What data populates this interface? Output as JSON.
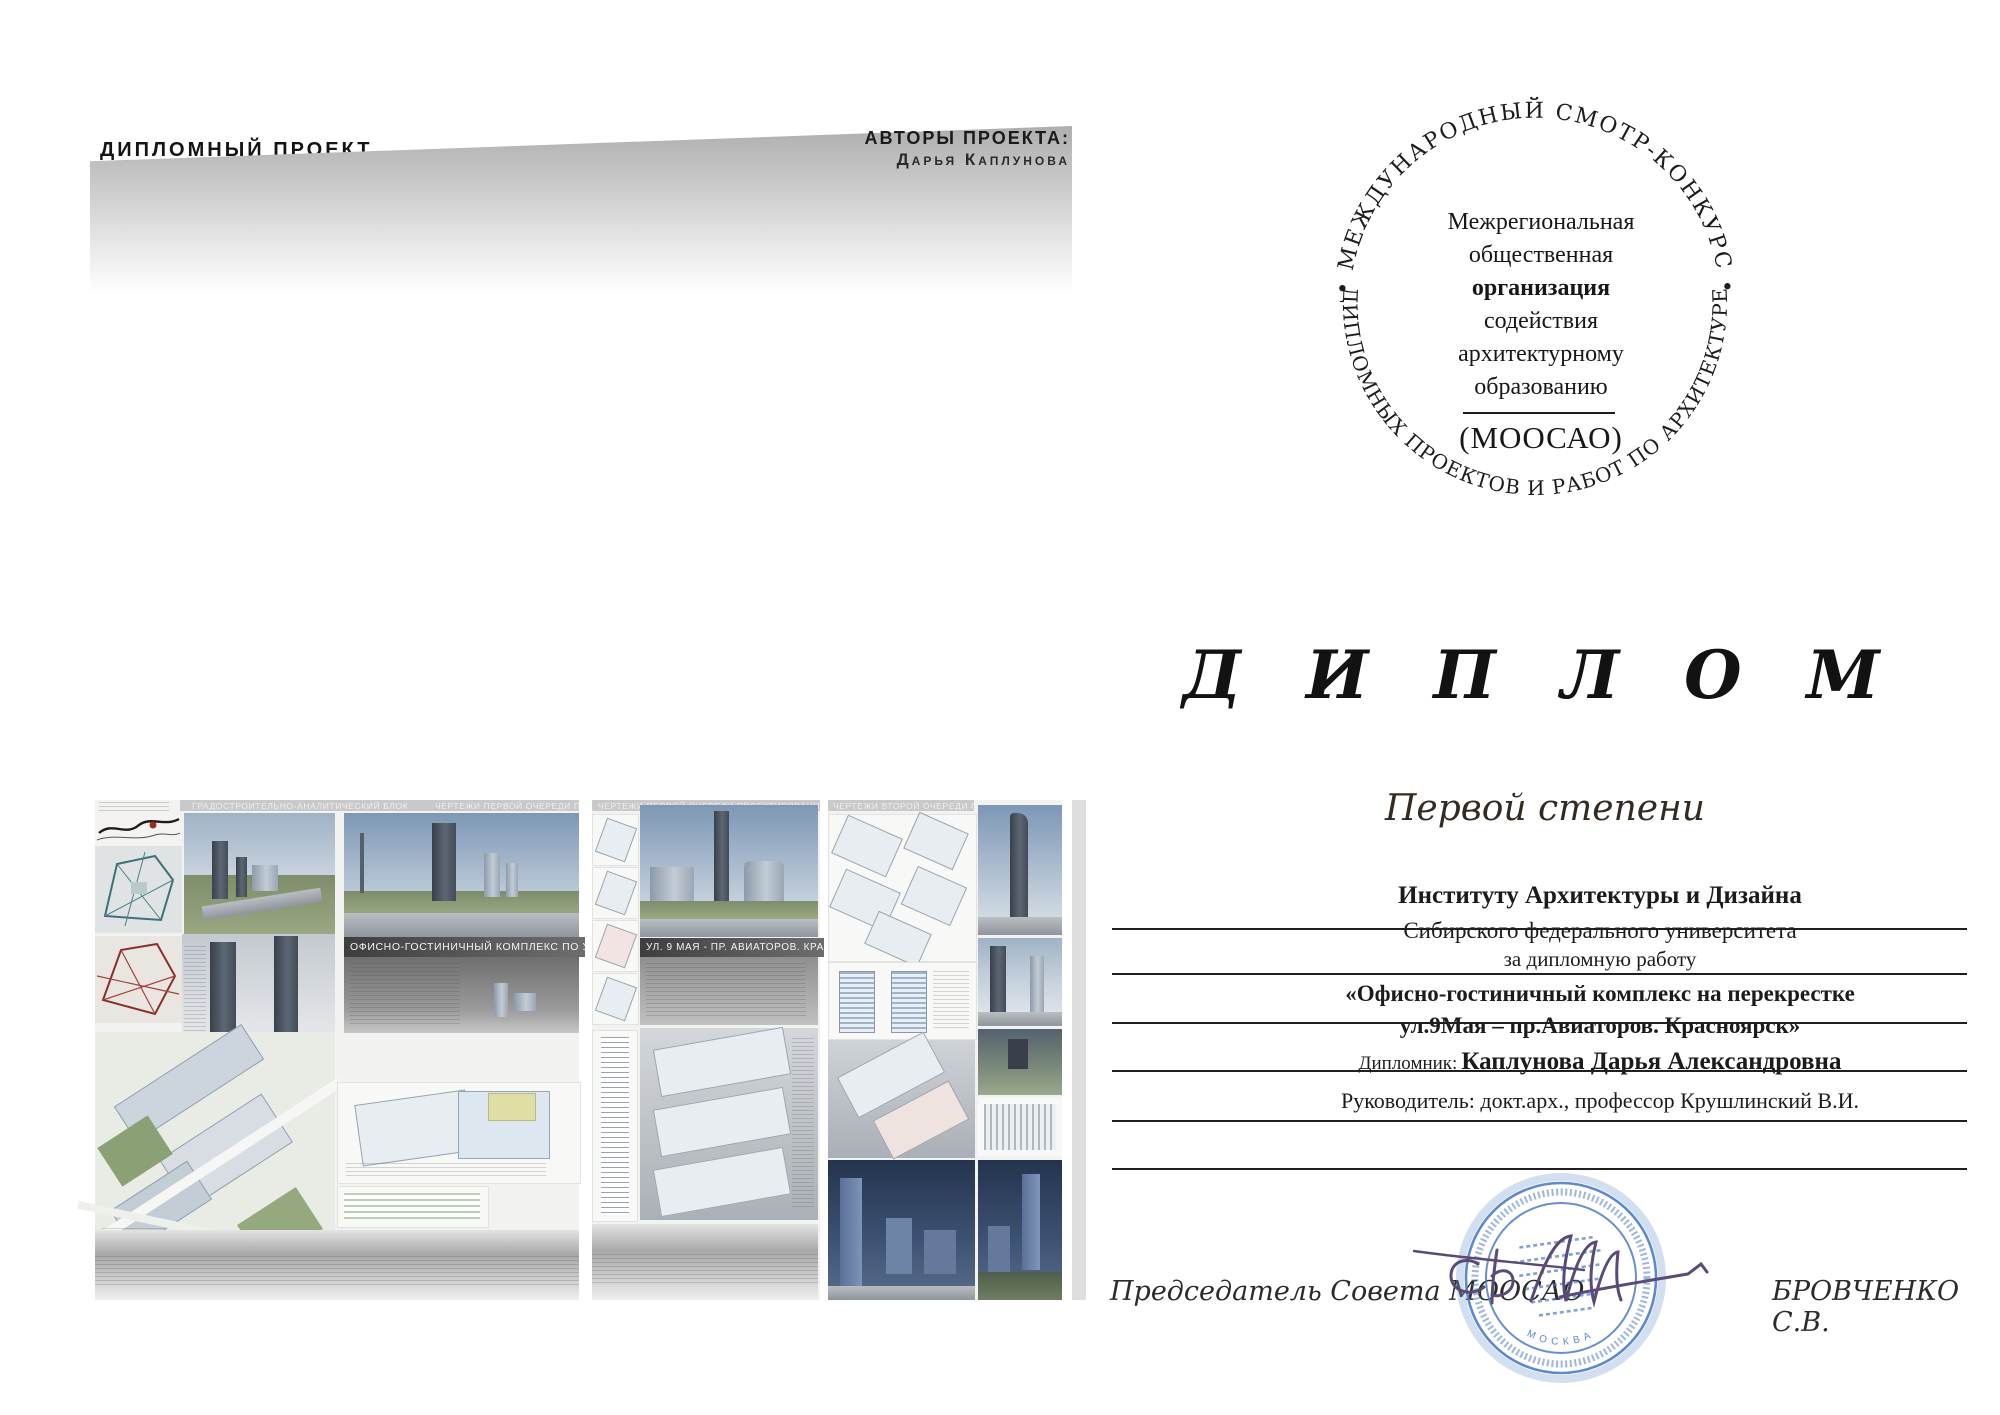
{
  "left_board": {
    "project_type": "ДИПЛОМНЫЙ ПРОЕКТ",
    "authors_label": "АВТОРЫ ПРОЕКТА:",
    "author_name": "Дарья Каплунова",
    "section_headers": [
      "ГРАДОСТРОИТЕЛЬНО-АНАЛИТИЧЕСКИЙ БЛОК",
      "ЧЕРТЕЖИ ПЕРВОЙ ОЧЕРЕДИ ПРОЕКТИРОВАНИЯ",
      "ЧЕРТЕЖИ ПЕРВОЙ ОЧЕРЕДИ ПРОЕКТИРОВАНИЯ",
      "ЧЕРТЕЖИ ВТОРОЙ ОЧЕРЕДИ ПРОЕКТИРОВАНИЯ"
    ],
    "banner_1": "ОФИСНО-ГОСТИНИЧНЫЙ КОМПЛЕКС ПО УЛ. 9 МАЯ -",
    "banner_2": "УЛ. 9 МАЯ - ПР. АВИАТОРОВ.  КРАСНОЯРСК.",
    "genplan_caption": "ГЕНПЛАН М 1:1000"
  },
  "diploma": {
    "seal": {
      "arc_top": "• МЕЖДУНАРОДНЫЙ СМОТР-КОНКУРС •",
      "arc_bottom": "ДИПЛОМНЫХ ПРОЕКТОВ И РАБОТ ПО АРХИТЕКТУРЕ",
      "org_line1": "Межрегиональная",
      "org_line2": "общественная",
      "org_line3": "организация",
      "org_line4": "содействия",
      "org_line5": "архитектурному",
      "org_line6": "образованию",
      "abbr": "(МООСАО)"
    },
    "title": "Д И П Л О М",
    "degree": "Первой степени",
    "recipient_line1": "Институту Архитектуры и Дизайна",
    "recipient_line2": "Сибирского федерального университета",
    "for_line": "за дипломную работу",
    "work_title_line1": "«Офисно-гостиничный комплекс на перекрестке",
    "work_title_line2": "ул.9Мая – пр.Авиаторов. Красноярск»",
    "graduate_label": "Дипломник:",
    "graduate_name": "Каплунова Дарья Александровна",
    "supervisor_line": "Руководитель: докт.арх., профессор Крушлинский В.И.",
    "footer_left": "Председатель Совета МООСАО",
    "footer_right": "БРОВЧЕНКО С.В.",
    "stamp_city": "МОСКВА"
  },
  "colors": {
    "stamp_blue": "#4d7cc4",
    "signature_ink": "#5a4a78",
    "banner_gray": "#4a4a4a",
    "band_gray": "#b9b9b9"
  }
}
